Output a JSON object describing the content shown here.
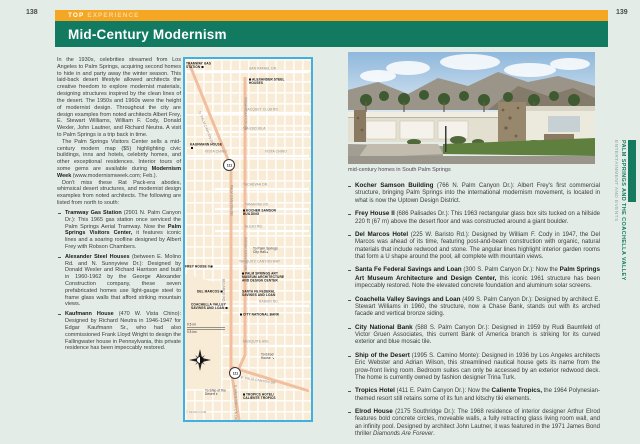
{
  "colors": {
    "kicker_bar": "#f5a623",
    "title_bar": "#117a61",
    "map_border": "#3fb0e0",
    "map_bg": "#f8ecd7",
    "road_salmon": "#f1bf9f",
    "sidebar_green": "#157a5f"
  },
  "left_page": {
    "number": "138",
    "kicker_strong": "TOP",
    "kicker_rest": "EXPERIENCE",
    "title": "Mid-Century Modernism",
    "p1": "In the 1930s, celebrities streamed from Los Angeles to Palm Springs, acquiring second homes to hide in and party away the winter season. This laid-back desert lifestyle allowed architects the creative freedom to explore modernist materials, designing structures inspired by the clean lines of the desert. The 1950s and 1960s were the height of modernist design. Throughout the city are design examples from noted architects Albert Frey, E. Stewart Williams, William F. Cody, Donald Wexler, John Lautner, and Richard Neutra. A visit to Palm Springs is a trip back in time.",
    "p2_t1": "The Palm Springs Visitors Center sells a mid-century modern map ($5) highlighting civic buildings, inns and hotels, celebrity homes, and other exceptional residences. Interior tours of some gems are available during ",
    "p2_b1": "Modernism Week",
    "p2_t2": " (www.modernismweek.com; Feb.).",
    "p3": "Don't miss these Rat Pack-era abodes, whimsical desert structures, and modernist design examples from noted architects. The following are listed from north to south:",
    "bullets": [
      {
        "lead": "Tramway Gas Station",
        "t1": " (2901 N. Palm Canyon Dr.): This 1965 gas station once serviced the Palm Springs Aerial Tramway. Now the ",
        "b1": "Palm Springs Visitors Center,",
        "t2": " it features iconic lines and a soaring roofline designed by Albert Frey with Robson Chambers."
      },
      {
        "lead": "Alexander Steel Houses",
        "t1": " (between E. Molino Rd. and N. Sunnyview Dr.): Designed by Donald Wexler and Richard Harrison and built in 1960-1962 by the George Alexander Construction company, these seven prefabricated homes use light-gauge steel to frame glass walls that afford striking mountain views."
      },
      {
        "lead": "Kaufmann House",
        "t1": " (470 W. Vista Chino): Designed by Richard Neutra in 1946-1947 for Edgar Kaufmann Sr., who had also commissioned Frank Lloyd Wright to design the Fallingwater house in Pennsylvania, this private residence has been impeccably restored."
      }
    ]
  },
  "map": {
    "streets": [
      "SAN RAFAEL DR.",
      "RACQUET CLUB RD.",
      "VIA ESCUELA",
      "VISTA CHINO",
      "TACHEVAH DR.",
      "TAMARISK RD.",
      "ALEJO RD.",
      "TAHQUITZ CANYON WAY",
      "RAMON RD.",
      "MESQUITE AVE.",
      "E. PALM CANYON DR.",
      "INDIAN CANYON DR.",
      "N. PALM CANYON DR.",
      "PALM CANYON DR.",
      "BELARDO RD.",
      "S. PALM CANYON DR."
    ],
    "pois": [
      "TRAMWAY GAS STATION",
      "ALEXANDER STEEL HOUSES",
      "KAUFMANN HOUSE",
      "KOCHER SAMSON BUILDING",
      "FREY HOUSE II",
      "PALM SPRINGS ART MUSEUM ARCHITECTURE AND DESIGN CENTER",
      "SANTA FE FEDERAL SAVINGS AND LOAN",
      "DEL MARCOS",
      "COACHELLA VALLEY SAVINGS AND LOAN",
      "CITY NATIONAL BANK",
      "TROPICS HOTEL/ CALIENTE TROPICS"
    ],
    "notes": [
      {
        "text": "To Palm Springs City Hall",
        "arrow": "▸"
      },
      {
        "text": "To Elrod House",
        "arrow": "↘"
      },
      {
        "text": "To Ship of the Desert",
        "arrow": "▾"
      }
    ],
    "shield": "111",
    "scale_mi": "0.5 mi",
    "scale_km": "0.5 km",
    "credit": "© MOON.COM"
  },
  "right_page": {
    "number": "139",
    "caption": "mid-century homes in South Palm Springs",
    "bullets": [
      {
        "lead": "Kocher Samson Building",
        "t1": " (766 N. Palm Canyon Dr.): Albert Frey's first commercial structure, bringing Palm Springs into the international modernism movement, is located in what is now the Uptown Design District."
      },
      {
        "lead": "Frey House II",
        "t1": " (686 Palisades Dr.): This 1963 rectangular glass box sits tucked on a hillside 220 ft (67 m) above the desert floor and was constructed around a giant boulder."
      },
      {
        "lead": "Del Marcos Hotel",
        "t1": " (225 W. Baristo Rd.): Designed by William F. Cody in 1947, the Del Marcos was ahead of its time, featuring post-and-beam construction with organic, natural materials that include redwood and stone. The angular lines highlight interior garden rooms that form a U shape around the pool, all complete with mountain views."
      },
      {
        "lead": "Santa Fe Federal Savings and Loan",
        "t1": " (300 S. Palm Canyon Dr.): Now the ",
        "b1": "Palm Springs Art Museum Architecture and Design Center,",
        "t2": " this iconic 1961 structure has been impeccably restored. Note the elevated concrete foundation and aluminum solar screens."
      },
      {
        "lead": "Coachella Valley Savings and Loan",
        "t1": " (499 S. Palm Canyon Dr.): Designed by architect E. Stewart Williams in 1960, the structure, now a Chase Bank, stands out with its arched facade and vertical bronze siding."
      },
      {
        "lead": "City National Bank",
        "t1": " (588 S. Palm Canyon Dr.): Designed in 1959 by Rudi Baumfeld of Victor Gruen Associates, this current Bank of America branch is striking for its curved exterior and blue mosaic tile."
      },
      {
        "lead": "Ship of the Desert",
        "t1": " (1995 S. Camino Monte): Designed in 1936 by Los Angeles architects Eric Webster and Adrian Wilson, this streamlined nautical house gets its name from the prow-front living room. Bedroom suites can only be accessed by an exterior redwood deck. The home is currently owned by fashion designer Trina Turk."
      },
      {
        "lead": "Tropics Hotel",
        "t1": " (411 E. Palm Canyon Dr.): Now the ",
        "b1": "Caliente Tropics,",
        "t2": " the 1964 Polynesian-themed resort still retains some of its fun and kitschy tiki elements."
      },
      {
        "lead": "Elrod House",
        "t1": " (2175 Southridge Dr.): The 1968 residence of interior designer Arthur Elrod features bold concrete circles, moveable walls, a fully retracting glass living room wall, and an infinity pool. Designed by architect John Lautner, it was featured in the 1971 James Bond thriller ",
        "i1": "Diamonds Are Forever",
        "t3": "."
      }
    ]
  },
  "sidebar": {
    "chapter": "PALM SPRINGS AND THE COACHELLA VALLEY",
    "section": "ENTERTAINMENT AND EVENTS"
  }
}
